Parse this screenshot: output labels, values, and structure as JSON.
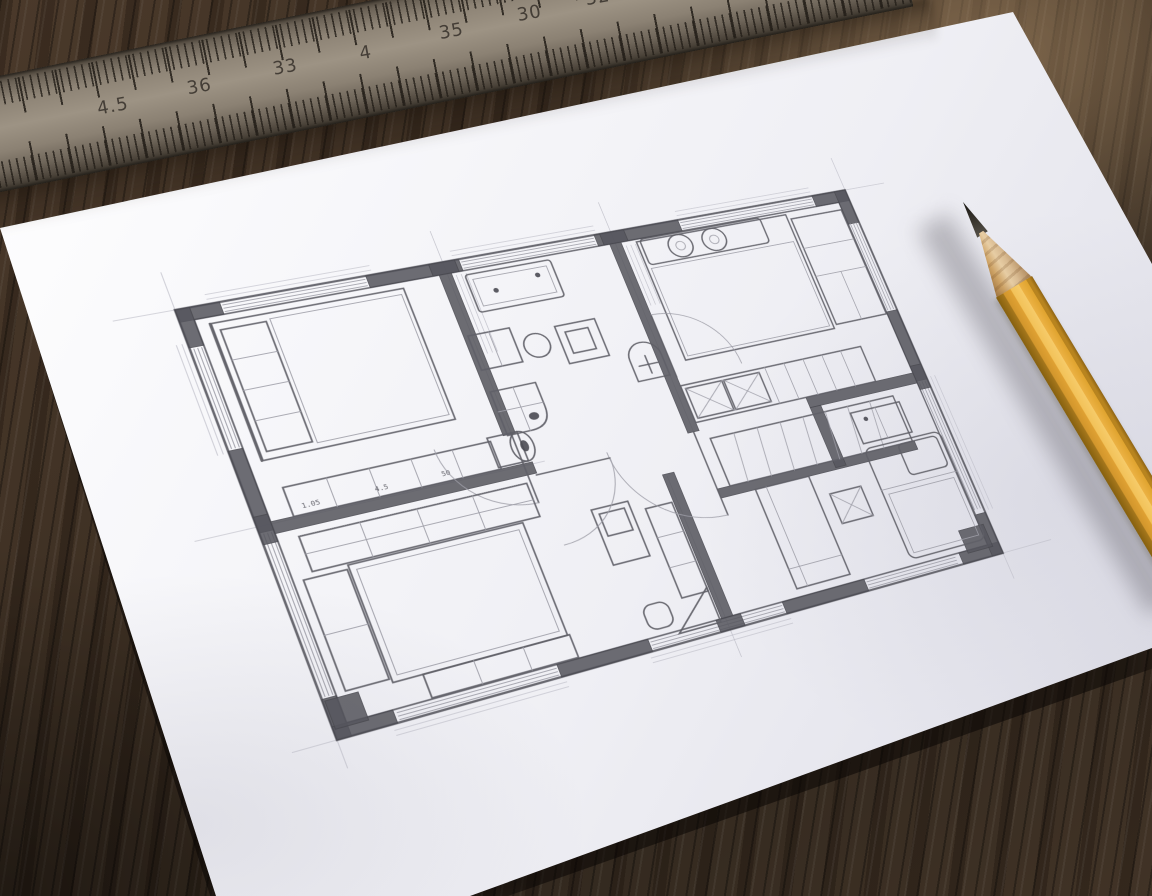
{
  "scene": {
    "description": "Photograph of a hand-drawn architectural floor plan sketched in pencil on a white sheet of paper, lying on a dark wooden desk with a steel ruler across the top edge and a sharpened yellow pencil on the right",
    "objects": [
      "wooden desk surface",
      "white paper sheet",
      "steel ruler",
      "yellow hexagonal pencil",
      "pencil floor plan sketch"
    ]
  },
  "colors": {
    "wood_dark": "#382c21",
    "wood_highlight": "#8a6f52",
    "paper_white": "#f7f7fa",
    "paper_shadow_tint": "#d9d9e3",
    "pencil_line": "#5f5f67",
    "wall_poche": "#55555d",
    "guide_line": "#bdbdc7",
    "ruler_metal": "#9d9384",
    "ruler_edge": "#443c32",
    "ruler_numerals": "#36302a",
    "pencil_body_yellow": "#e0a42f",
    "pencil_body_highlight": "#f6cb69",
    "pencil_body_shadow": "#8f6414",
    "pencil_wood": "#cda265",
    "pencil_graphite": "#26221f"
  },
  "ruler": {
    "tick_labels": [
      "4.5",
      "36",
      "33",
      "4",
      "35",
      "30",
      "32",
      "3",
      "85",
      "38"
    ]
  },
  "pencil": {
    "style": "hexagonal yellow pencil, sharpened graphite tip pointing up-left"
  },
  "floor_plan": {
    "medium": "pencil sketch, plan view with dark wall poche and guide lines",
    "rooms": [
      "bedroom (top left)",
      "bathroom (top centre)",
      "bedroom (top right)",
      "staircase (centre right)",
      "bedroom (bottom left)",
      "hallway (centre)",
      "living room / bedroom (bottom right)"
    ],
    "furniture": [
      "double beds with pillows",
      "wardrobe",
      "sideboards",
      "washbasin",
      "toilet",
      "corner shower",
      "stool",
      "tables",
      "sofa",
      "stairs with cross-marked treads",
      "rolled rug",
      "door swing arcs"
    ],
    "sketch_marks": [
      "1.05",
      "4.5",
      "50"
    ]
  }
}
